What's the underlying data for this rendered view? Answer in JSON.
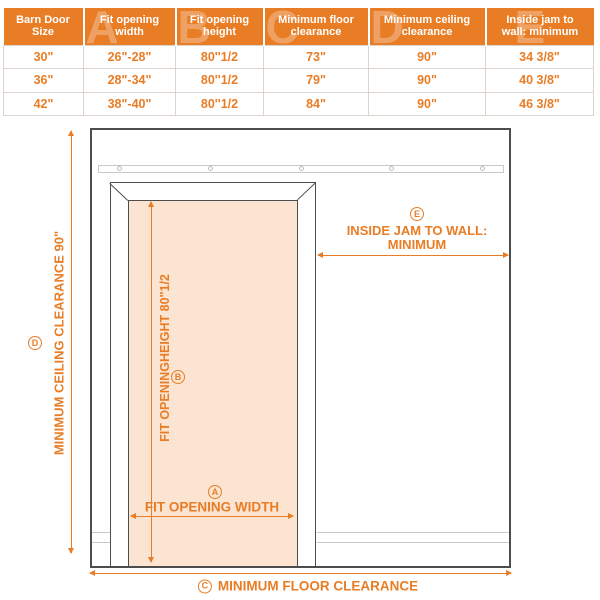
{
  "table": {
    "headers": [
      {
        "line1": "Barn Door",
        "line2": "Size",
        "letter": ""
      },
      {
        "line1": "Fit opening",
        "line2": "width",
        "letter": "A"
      },
      {
        "line1": "Fit opening",
        "line2": "height",
        "letter": "B"
      },
      {
        "line1": "Minimum floor",
        "line2": "clearance",
        "letter": "C"
      },
      {
        "line1": "Minimum ceiling",
        "line2": "clearance",
        "letter": "D"
      },
      {
        "line1": "Inside jam to",
        "line2": "wall: minimum",
        "letter": "E"
      }
    ],
    "rows": [
      [
        "30\"",
        "26\"-28\"",
        "80''1/2",
        "73\"",
        "90\"",
        "34 3/8\""
      ],
      [
        "36\"",
        "28\"-34\"",
        "80''1/2",
        "79\"",
        "90\"",
        "40 3/8\""
      ],
      [
        "42\"",
        "38\"-40\"",
        "80''1/2",
        "84\"",
        "90\"",
        "46 3/8\""
      ]
    ]
  },
  "diagram": {
    "label_a": {
      "letter": "A",
      "text": "FIT OPENING WIDTH"
    },
    "label_b": {
      "letter": "B",
      "text": "FIT OPENINGHEIGHT 80''1/2"
    },
    "label_c": {
      "letter": "C",
      "text": "MINIMUM FLOOR CLEARANCE"
    },
    "label_d": {
      "letter": "D",
      "text": "MINIMUM CEILING CLEARANCE 90\""
    },
    "label_e": {
      "letter": "E",
      "line1": "INSIDE JAM TO WALL:",
      "line2": "MINIMUM"
    }
  },
  "colors": {
    "orange": "#E87D26",
    "peach": "#FBE4D2",
    "line_dark": "#4D4D4D",
    "line_light": "#C9C9C9"
  }
}
